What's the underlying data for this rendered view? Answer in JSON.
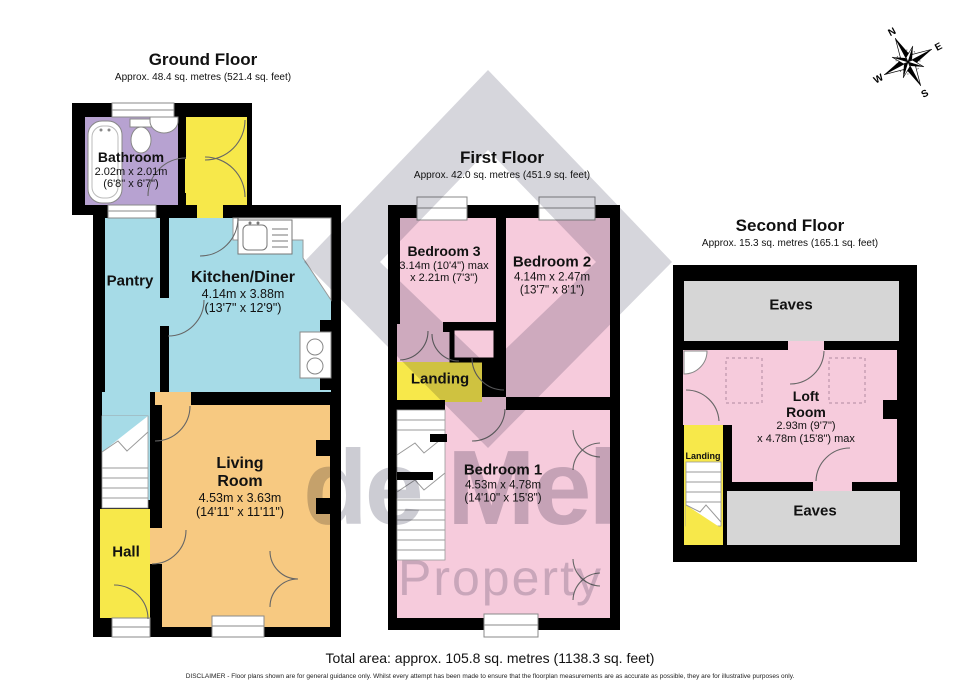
{
  "watermark": {
    "line1": "de Mel",
    "line2": "Property"
  },
  "compass": {
    "n": "N",
    "e": "E",
    "s": "S",
    "w": "W"
  },
  "floors": [
    {
      "id": "ground",
      "title": "Ground Floor",
      "subtitle": "Approx. 48.4 sq. metres (521.4 sq. feet)",
      "rooms": [
        {
          "id": "bathroom",
          "label": "Bathroom",
          "dims": "2.02m x 2.01m",
          "dims2": "(6'8\" x 6'7\")"
        },
        {
          "id": "pantry",
          "label": "Pantry"
        },
        {
          "id": "kitchen-diner",
          "label": "Kitchen/Diner",
          "dims": "4.14m x 3.88m",
          "dims2": "(13'7\" x 12'9\")"
        },
        {
          "id": "living-room",
          "label": "Living Room",
          "dims": "4.53m x 3.63m",
          "dims2": "(14'11\" x 11'11\")"
        },
        {
          "id": "hall",
          "label": "Hall"
        }
      ]
    },
    {
      "id": "first",
      "title": "First Floor",
      "subtitle": "Approx. 42.0 sq. metres (451.9 sq. feet)",
      "rooms": [
        {
          "id": "bedroom-3",
          "label": "Bedroom 3",
          "dims": "3.14m (10'4\") max",
          "dims2": "x 2.21m (7'3\")"
        },
        {
          "id": "bedroom-2",
          "label": "Bedroom 2",
          "dims": "4.14m x 2.47m",
          "dims2": "(13'7\" x 8'1\")"
        },
        {
          "id": "landing",
          "label": "Landing"
        },
        {
          "id": "bedroom-1",
          "label": "Bedroom 1",
          "dims": "4.53m x 4.78m",
          "dims2": "(14'10\" x 15'8\")"
        }
      ]
    },
    {
      "id": "second",
      "title": "Second Floor",
      "subtitle": "Approx. 15.3 sq. metres (165.1 sq. feet)",
      "rooms": [
        {
          "id": "eaves-top",
          "label": "Eaves"
        },
        {
          "id": "loft-room",
          "label": "Loft Room",
          "dims": "2.93m (9'7\")",
          "dims2": "x 4.78m (15'8\") max"
        },
        {
          "id": "landing-2",
          "label": "Landing"
        },
        {
          "id": "eaves-bottom",
          "label": "Eaves"
        }
      ]
    }
  ],
  "footer": {
    "total_area": "Total area: approx. 105.8 sq. metres (1138.3 sq. feet)",
    "disclaimer": "DISCLAIMER - Floor plans shown are for general guidance only. Whilst every attempt has been made to ensure that the floorplan measurements are as accurate as possible, they are for illustrative purposes only."
  },
  "colors": {
    "wall": "#000000",
    "bathroom": "#b7a2d1",
    "yellow": "#f7e84a",
    "kitchen": "#a6dbe7",
    "living": "#f7c981",
    "bedroom": "#f6cbdc",
    "eaves": "#d6d6d6",
    "watermark": "#9d9dab"
  }
}
